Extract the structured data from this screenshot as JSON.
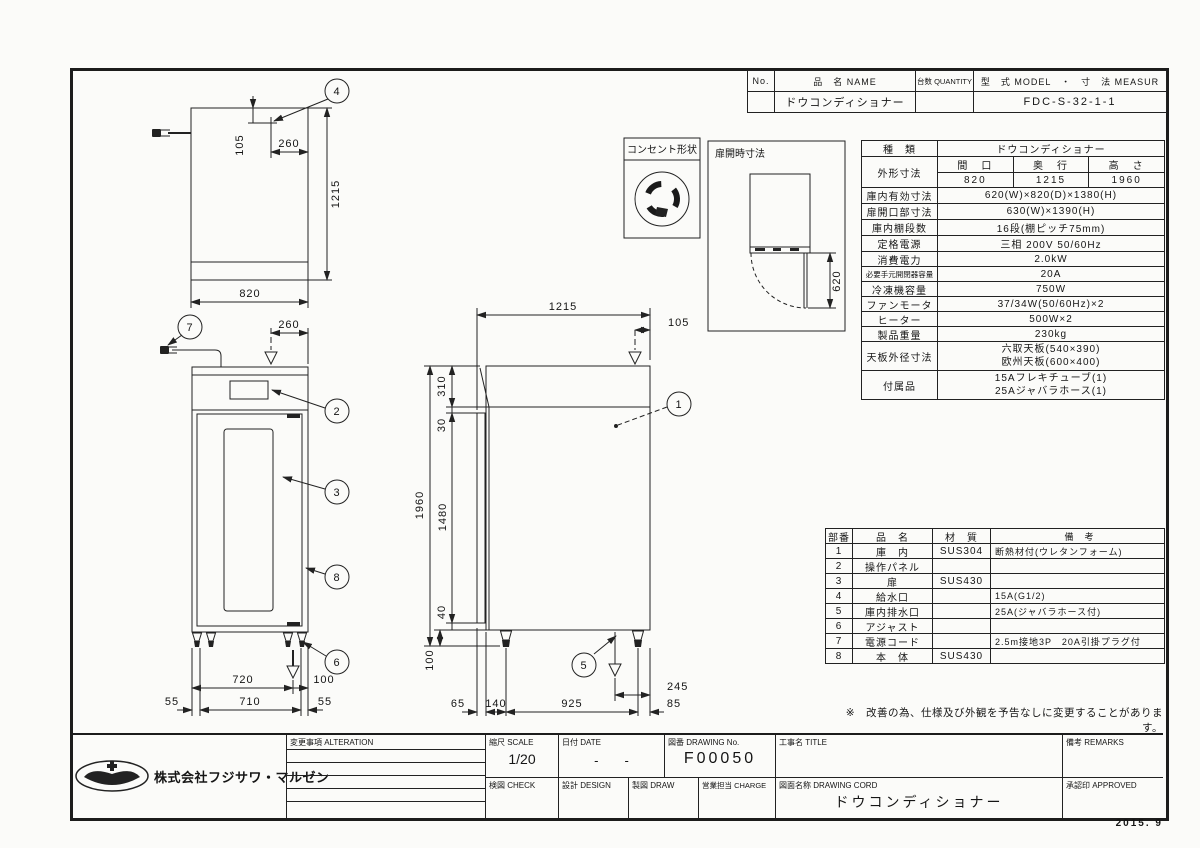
{
  "sheet": {
    "date_stamp": "2015. 9"
  },
  "name_table": {
    "h_no": "No.",
    "h_name": "品　名 NAME",
    "h_qty": "台数 QUANTITY",
    "h_model": "型　式 MODEL　・　寸　法 MEASUR",
    "v_no": "",
    "v_name": "ドウコンディショナー",
    "v_qty": "",
    "v_model": "FDC-S-32-1-1"
  },
  "spec": {
    "kind_label": "種　類",
    "kind_value": "ドウコンディショナー",
    "outer_label": "外形寸法",
    "col_w": "間　口",
    "col_d": "奥　行",
    "col_h": "高　さ",
    "val_w": "820",
    "val_d": "1215",
    "val_h": "1960",
    "rows": [
      {
        "label": "庫内有効寸法",
        "value": "620(W)×820(D)×1380(H)"
      },
      {
        "label": "扉開口部寸法",
        "value": "630(W)×1390(H)"
      },
      {
        "label": "庫内棚段数",
        "value": "16段(棚ピッチ75mm)"
      },
      {
        "label": "定格電源",
        "value": "三相 200V 50/60Hz"
      },
      {
        "label": "消費電力",
        "value": "2.0kW"
      },
      {
        "label": "必要手元開閉器容量",
        "value": "20A"
      },
      {
        "label": "冷凍機容量",
        "value": "750W"
      },
      {
        "label": "ファンモータ",
        "value": "37/34W(50/60Hz)×2"
      },
      {
        "label": "ヒーター",
        "value": "500W×2"
      },
      {
        "label": "製品重量",
        "value": "230kg"
      }
    ],
    "top_label": "天板外径寸法",
    "top_line1": "六取天板(540×390)",
    "top_line2": "欧州天板(600×400)",
    "acc_label": "付属品",
    "acc_line1": "15Aフレキチューブ(1)",
    "acc_line2": "25Aジャバラホース(1)"
  },
  "parts": {
    "h_no": "部番",
    "h_name": "品　名",
    "h_mat": "材　質",
    "h_note": "備　考",
    "rows": [
      {
        "no": "1",
        "name": "庫　内",
        "mat": "SUS304",
        "note": "断熱材付(ウレタンフォーム)"
      },
      {
        "no": "2",
        "name": "操作パネル",
        "mat": "",
        "note": ""
      },
      {
        "no": "3",
        "name": "扉",
        "mat": "SUS430",
        "note": ""
      },
      {
        "no": "4",
        "name": "給水口",
        "mat": "",
        "note": "15A(G1/2)"
      },
      {
        "no": "5",
        "name": "庫内排水口",
        "mat": "",
        "note": "25A(ジャバラホース付)"
      },
      {
        "no": "6",
        "name": "アジャスト",
        "mat": "",
        "note": ""
      },
      {
        "no": "7",
        "name": "電源コード",
        "mat": "",
        "note": "2.5m接地3P　20A引掛プラグ付"
      },
      {
        "no": "8",
        "name": "本　体",
        "mat": "SUS430",
        "note": ""
      }
    ]
  },
  "note": "※　改善の為、仕様及び外観を予告なしに変更することがあります。",
  "boxes": {
    "outlet": "コンセント形状",
    "door_open": "扉開時寸法"
  },
  "balloons": {
    "b1": "1",
    "b2": "2",
    "b3": "3",
    "b4": "4",
    "b5": "5",
    "b6": "6",
    "b7": "7",
    "b8": "8"
  },
  "dims": {
    "plan_105": "105",
    "plan_260": "260",
    "plan_1215": "1215",
    "plan_820": "820",
    "front_260": "260",
    "front_720": "720",
    "front_100": "100",
    "front_55l": "55",
    "front_710": "710",
    "front_55r": "55",
    "side_1215": "1215",
    "side_105": "105",
    "side_310": "310",
    "side_30": "30",
    "side_1960": "1960",
    "side_1480": "1480",
    "side_40": "40",
    "side_100": "100",
    "side_65": "65",
    "side_140": "140",
    "side_925": "925",
    "side_85": "85",
    "side_245": "245",
    "door_620": "620"
  },
  "title_block": {
    "company": "株式会社フジサワ・マルゼン",
    "alteration": "変更事項 ALTERATION",
    "scale_label": "縮尺 SCALE",
    "scale_value": "1/20",
    "date_label": "日付 DATE",
    "date_value": "-　　-",
    "dwgno_label": "図番 DRAWING  No.",
    "dwgno_value": "F00050",
    "title_label": "工事名 TITLE",
    "title_value": "",
    "remarks_label": "備考 REMARKS",
    "check_label": "検図 CHECK",
    "design_label": "設計 DESIGN",
    "draw_label": "製図 DRAW",
    "charge_label": "営業担当 CHARGE",
    "dwgname_label": "図面名称 DRAWING  CORD",
    "dwgname_value": "ドウコンディショナー",
    "approved_label": "承認印 APPROVED"
  }
}
